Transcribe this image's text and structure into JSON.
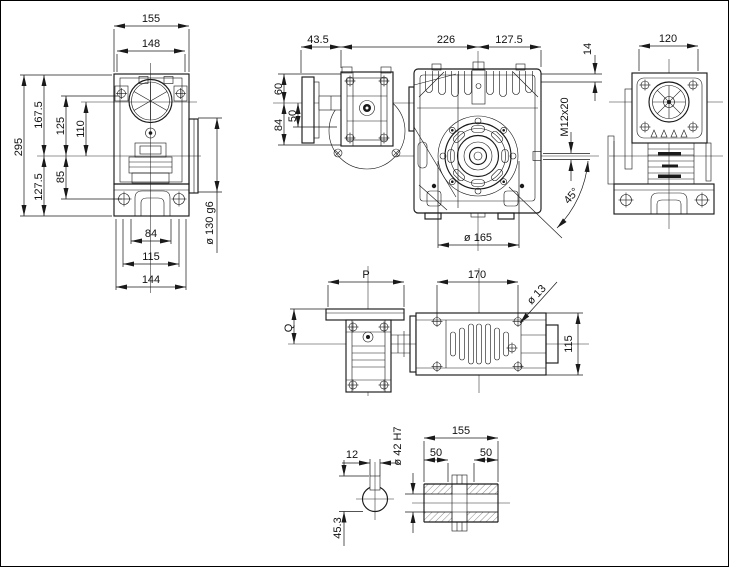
{
  "views": {
    "side_view_left": {
      "width_top": "155",
      "width_flange": "148",
      "height_total": "295",
      "height_center_top": "167.5",
      "dim_125": "125",
      "dim_110": "110",
      "dim_85": "85",
      "height_center_bottom": "127.5",
      "foot_width_inner": "84",
      "foot_width_mid": "115",
      "foot_width_outer": "144",
      "output_spigot": "ø 130 g6"
    },
    "front_view": {
      "dim_input_offset": "43.5",
      "dim_length": "226",
      "dim_half_width": "127.5",
      "dim_60": "60",
      "dim_50": "50",
      "dim_84": "84",
      "dim_14": "14",
      "thread_callout": "M12x20",
      "flange_diameter": "ø 165",
      "angle": "45°"
    },
    "side_view_right": {
      "width": "120"
    },
    "top_view": {
      "motor_flange_width": "P",
      "foot_hole_spacing": "170",
      "foot_hole_diameter": "ø 13",
      "dim_q": "Q",
      "body_depth": "115"
    },
    "shaft_detail": {
      "length": "155",
      "bore_depth_left": "50",
      "bore_depth_right": "50",
      "keyway_width": "12",
      "bore_diameter": "ø 42 H7",
      "keyway_depth": "45.3"
    }
  }
}
